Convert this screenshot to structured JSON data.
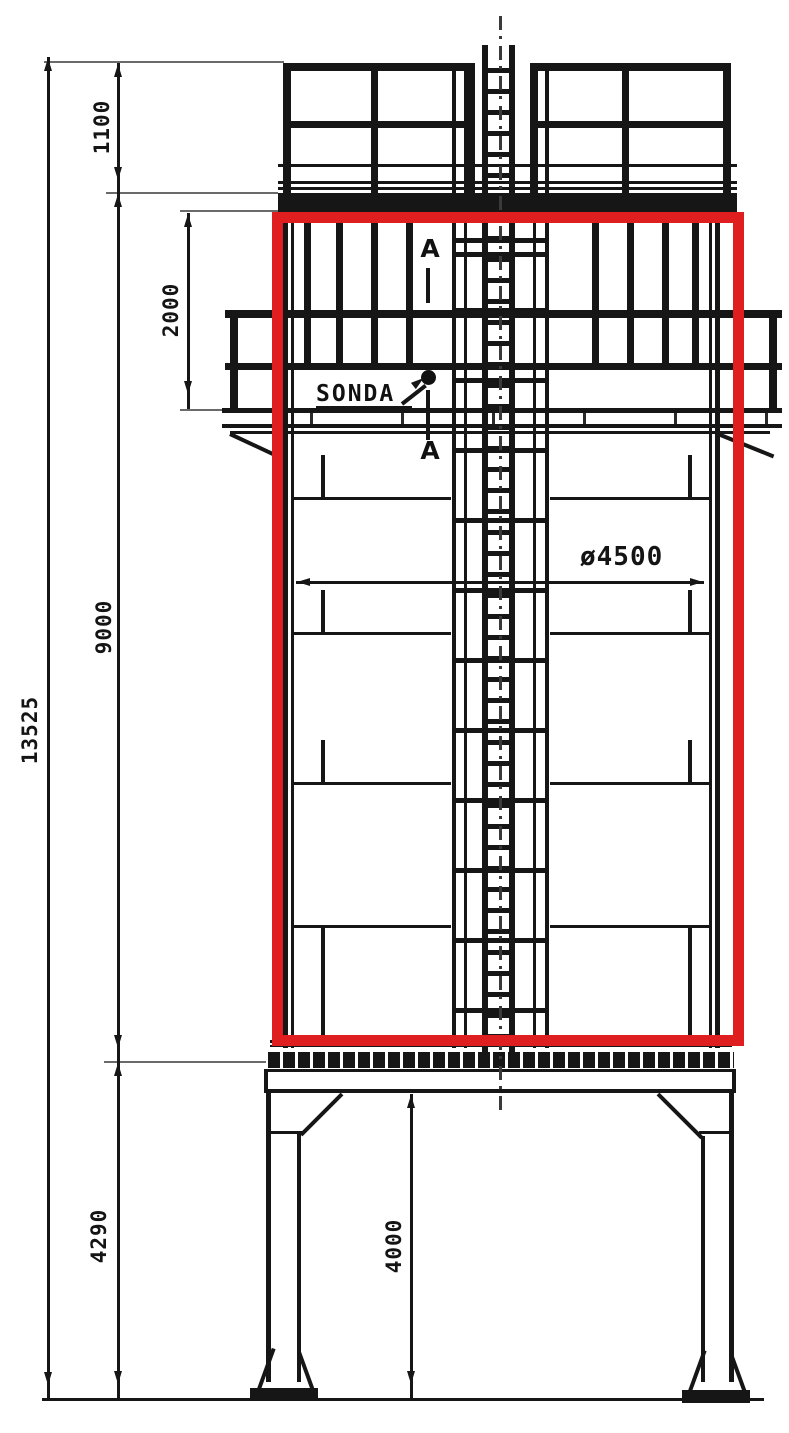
{
  "drawing": {
    "description": "silo elevation technical drawing with highlighted shell region",
    "dimensions": {
      "overall_height": "13525",
      "railing_height": "1100",
      "upper_section_height": "2000",
      "shell_height": "9000",
      "support_height": "4290",
      "ground_clearance": "4000",
      "shell_diameter": "ø4500"
    },
    "labels": {
      "probe": "SONDA",
      "section_marker_top": "A",
      "section_marker_bottom": "A"
    },
    "highlight": {
      "color": "#df1f1f"
    },
    "line_color": "#161616"
  }
}
